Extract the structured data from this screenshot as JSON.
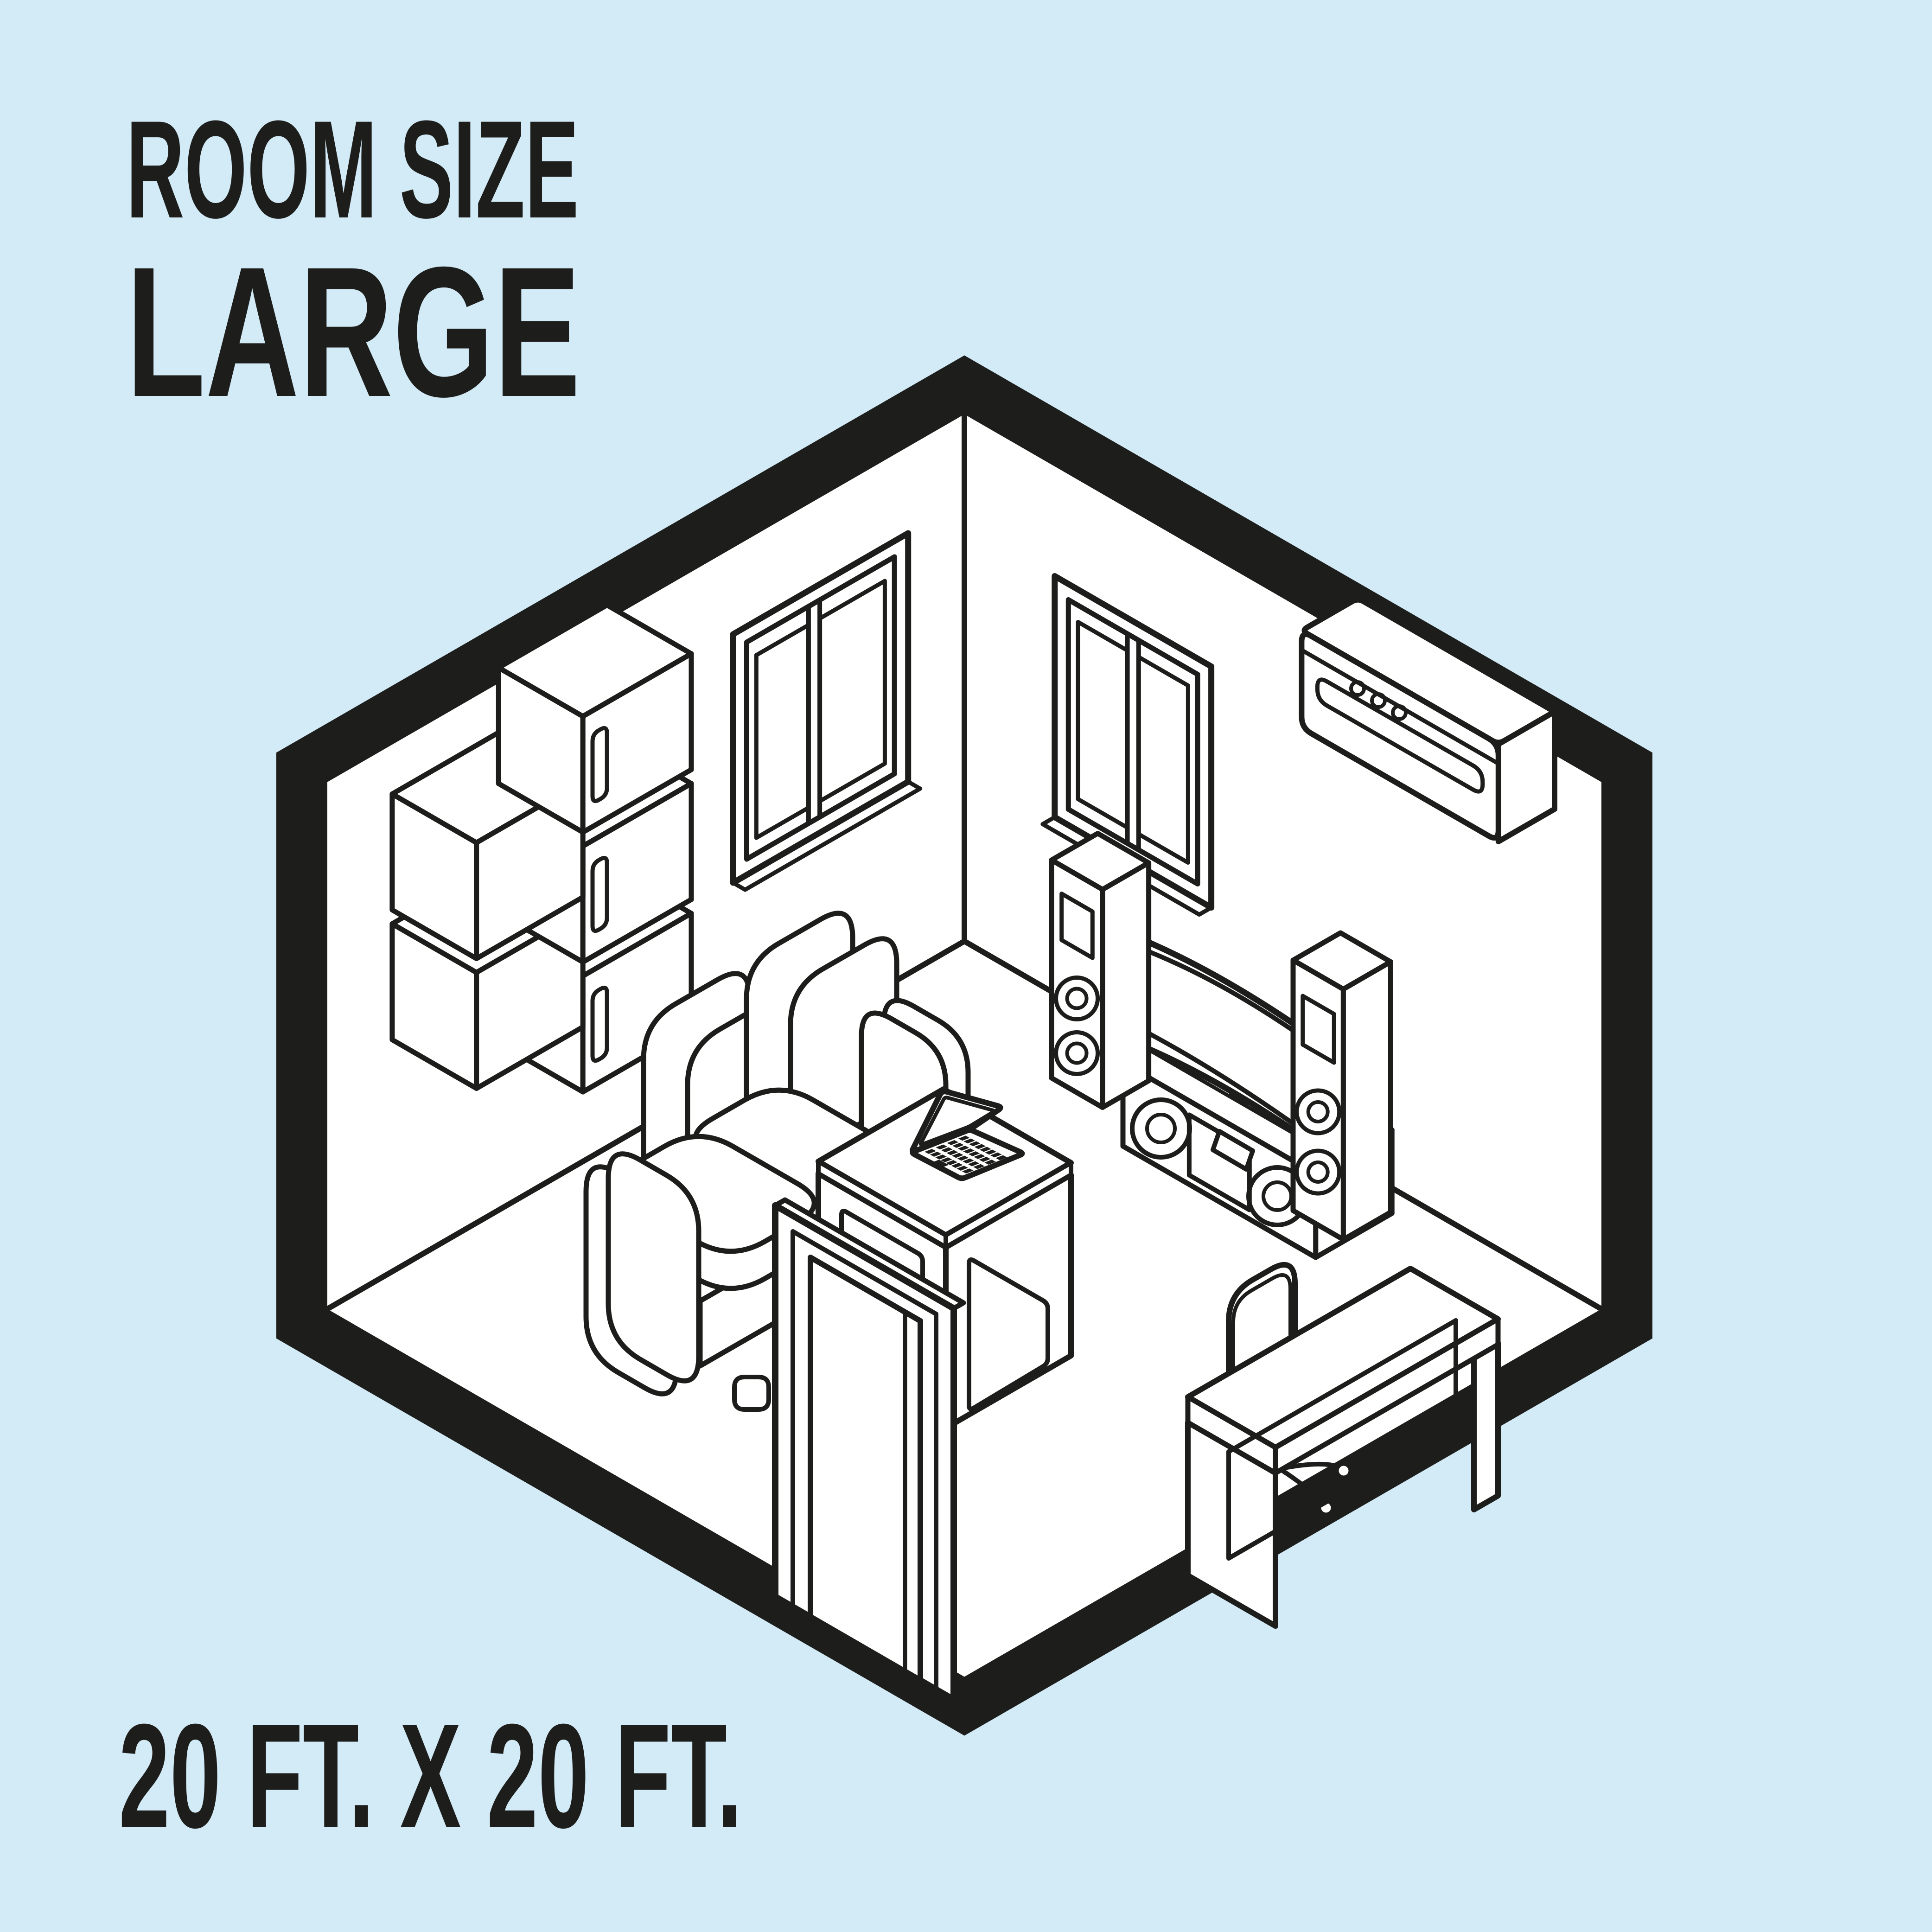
{
  "colors": {
    "background": "#d2ebf7",
    "ink": "#1d1d1b",
    "paper": "#ffffff"
  },
  "header": {
    "title": "ROOM SIZE",
    "size_label": "LARGE"
  },
  "footer": {
    "dimensions": "20 FT. X 20 FT."
  },
  "scene": {
    "type": "isometric-room-cutaway-illustration",
    "items": [
      {
        "name": "room-shell"
      },
      {
        "name": "wall-cabinets"
      },
      {
        "name": "window-left"
      },
      {
        "name": "window-right"
      },
      {
        "name": "air-conditioner"
      },
      {
        "name": "media-console"
      },
      {
        "name": "curved-tv"
      },
      {
        "name": "tower-speaker-left"
      },
      {
        "name": "tower-speaker-right"
      },
      {
        "name": "sofa"
      },
      {
        "name": "coffee-table"
      },
      {
        "name": "laptop"
      },
      {
        "name": "office-chair"
      },
      {
        "name": "desk"
      },
      {
        "name": "door"
      }
    ]
  }
}
